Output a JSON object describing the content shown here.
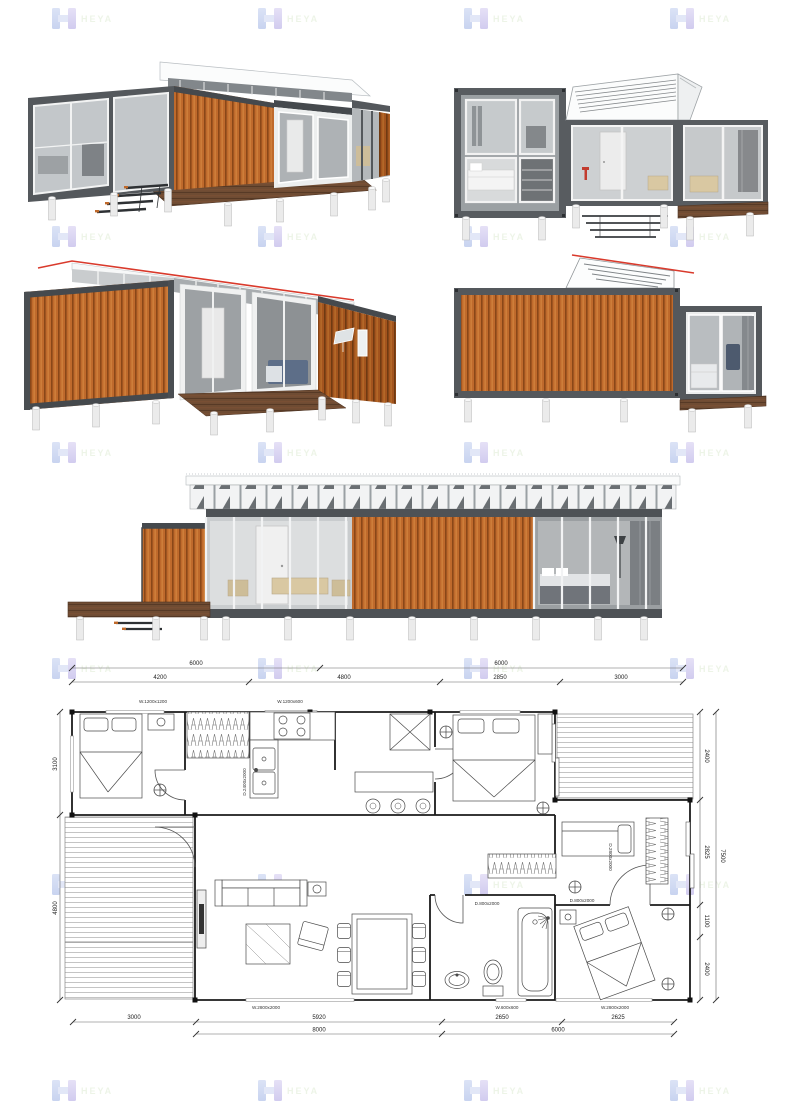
{
  "brand": {
    "watermark_text": "HEYA"
  },
  "colors": {
    "wood": "#bf6a2c",
    "wood_dark": "#a3541e",
    "frame_gray": "#54585c",
    "deck_brown": "#6f4c33",
    "glass_gray": "#c6c9cc",
    "roof_accent_red": "#d93a2c",
    "pier_white": "#ebebeb",
    "plan_line": "#1b1b1b"
  },
  "views": {
    "v1": "perspective-front-left",
    "v2": "elevation-front-split-modules",
    "v3": "perspective-rear-left",
    "v4": "elevation-side-wood-clad",
    "v5": "elevation-front-full-length"
  },
  "plan": {
    "dims": {
      "top_outer": [
        "6000",
        "6000"
      ],
      "top_inner": [
        "4200",
        "4800",
        "2850",
        "3000"
      ],
      "bottom_inner": [
        "3000",
        "5920",
        "2650",
        "2625"
      ],
      "bottom_outer": [
        "8000",
        "6000"
      ],
      "left": [
        "3100",
        "4800"
      ],
      "right_inner": [
        "2400",
        "2825",
        "1100",
        "2400"
      ],
      "right_outer": [
        "7500"
      ]
    },
    "labels": {
      "window_top_1": "W.1200x1200",
      "window_top_2": "W.1200x600",
      "window_bottom_1": "W.2800x2000",
      "window_bottom_2": "W.600x600",
      "window_bottom_3": "W.2800x2000",
      "door_right": "D.2800x2000",
      "door_kitchen": "D.2400x2000",
      "door_bath": "D.800x2000",
      "door_hall": "D.800x2000"
    }
  }
}
